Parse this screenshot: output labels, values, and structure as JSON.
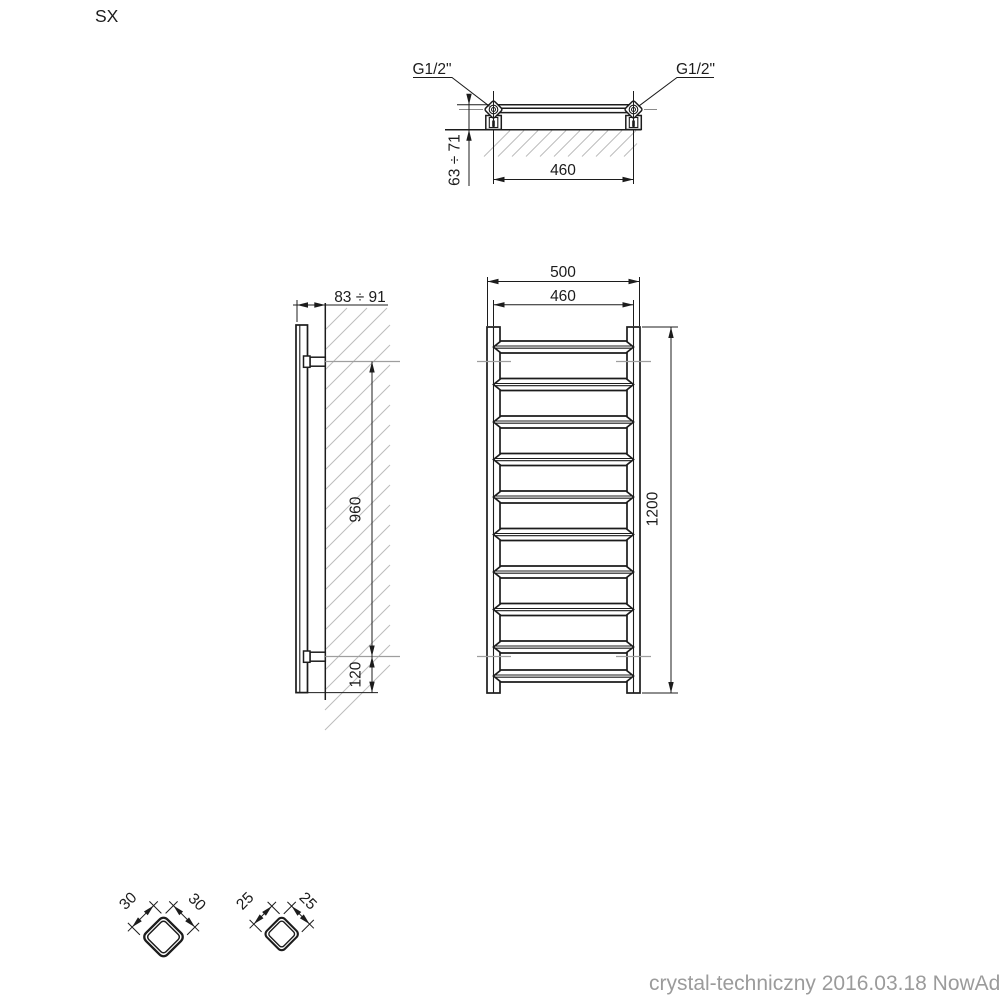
{
  "page": {
    "corner_label": "SX",
    "footer": "crystal-techniczny 2016.03.18 NowAd"
  },
  "top_view": {
    "connection_left": "G1/2\"",
    "connection_right": "G1/2\"",
    "connection_spacing": "460",
    "wall_offset_range": "63 ÷ 71"
  },
  "side_view": {
    "depth_range": "83 ÷ 91",
    "bracket_spacing": "960",
    "bottom_bracket_offset": "120"
  },
  "front_view": {
    "overall_width": "500",
    "connection_spacing": "460",
    "overall_height": "1200",
    "rung_count": 10
  },
  "cross_sections": {
    "vertical_tube_side_a": "30",
    "vertical_tube_side_b": "30",
    "rung_tube_side_a": "25",
    "rung_tube_side_b": "25"
  }
}
